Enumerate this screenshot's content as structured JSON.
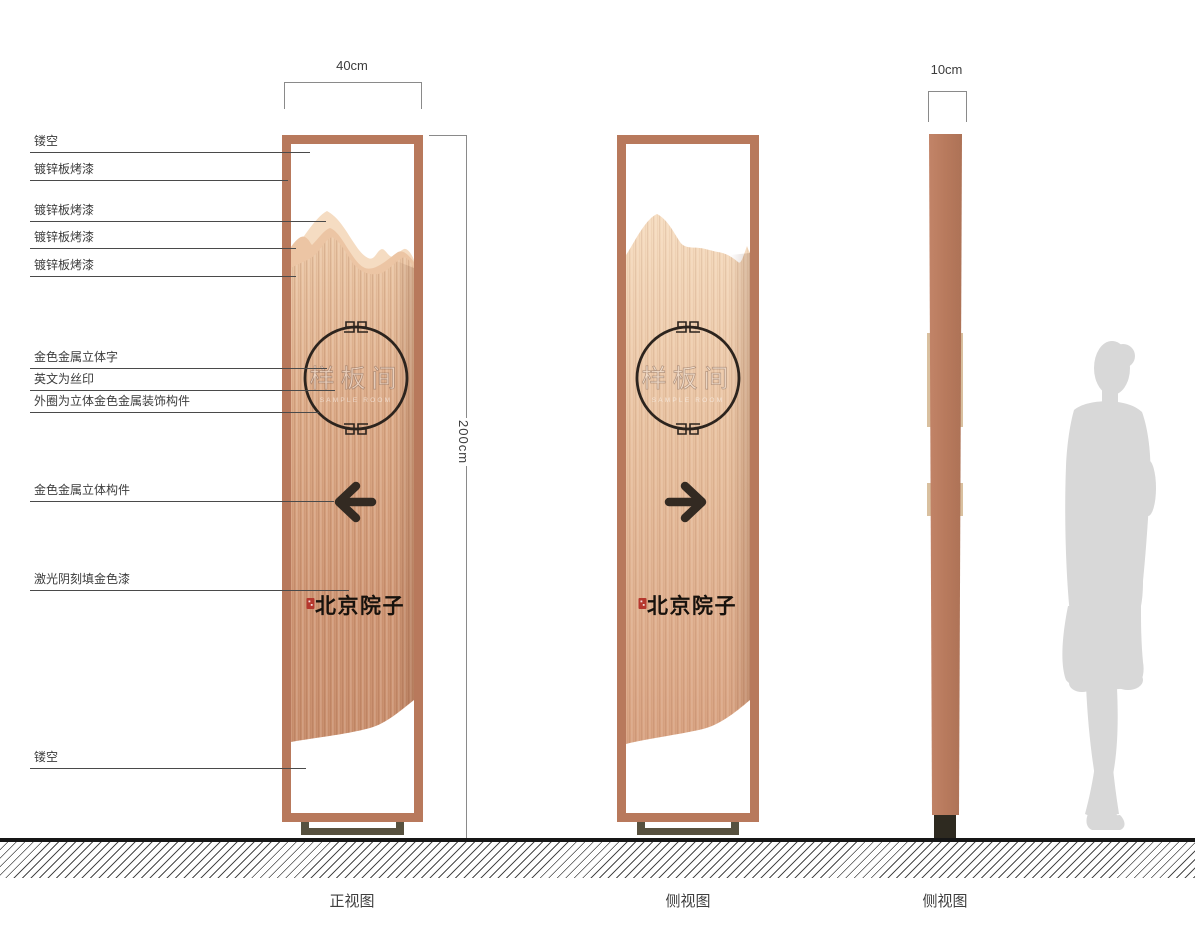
{
  "drawing": {
    "callouts": [
      "镂空",
      "镀锌板烤漆",
      "镀锌板烤漆",
      "镀锌板烤漆",
      "镀锌板烤漆",
      "金色金属立体字",
      "英文为丝印",
      "外圈为立体金色金属装饰构件",
      "金色金属立体构件",
      "激光阴刻填金色漆",
      "镂空"
    ],
    "dimensions": {
      "front_width": "40cm",
      "total_height": "200cm",
      "side_thickness": "10cm"
    },
    "captions": {
      "front_view": "正视图",
      "side_view_1": "侧视图",
      "side_view_2": "侧视图"
    },
    "sign": {
      "room_name": "样板间",
      "room_name_en": "SAMPLE ROOM",
      "brand_name": "北京院子"
    },
    "icons": {
      "front_arrow": "arrow-left-icon",
      "side_arrow": "arrow-right-icon",
      "brand_seal": "red-seal-stamp",
      "circle_ornament": "meander-ornament-icon"
    },
    "colors": {
      "frame_copper": "#b8795c",
      "body_copper": "#d3a07f",
      "mountain_light": "#f5dcc2",
      "mountain_mid": "#ecc5a4",
      "seal_red": "#b5382e",
      "base_metal": "#57513f",
      "ground_line": "#161616",
      "silhouette_gray": "#d8d8d8"
    }
  }
}
